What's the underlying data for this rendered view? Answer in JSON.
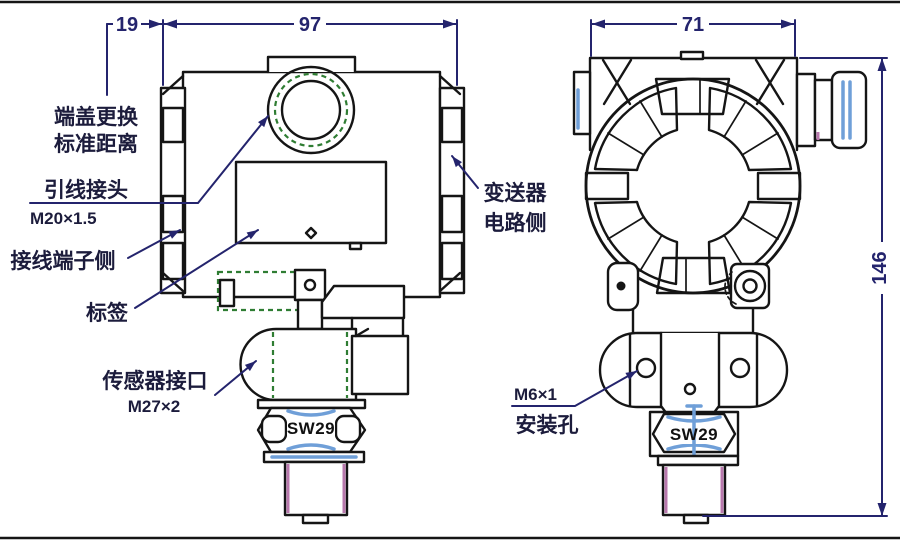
{
  "dimensions": {
    "cap_clearance": "19",
    "housing_length": "97",
    "housing_width": "71",
    "overall_height": "146"
  },
  "annotations": {
    "cap_note_line1": "端盖更换",
    "cap_note_line2": "标准距离",
    "cable_entry": "引线接头",
    "cable_entry_thread": "M20×1.5",
    "terminal_side": "接线端子侧",
    "tag": "标签",
    "sensor_port": "传感器接口",
    "sensor_port_thread": "M27×2",
    "circuit_side_line1": "变送器",
    "circuit_side_line2": "电路侧",
    "mounting_hole_thread": "M6×1",
    "mounting_hole": "安装孔",
    "wrench_size_side_view": "SW29",
    "wrench_size_front_view": "SW29"
  },
  "colors": {
    "outline": "#151515",
    "dimension_lines": "#24246d",
    "hidden_detail_green": "#2f7d33",
    "seal_pink": "#b878ad",
    "thread_blue": "#6f9fd8",
    "background": "#ffffff"
  }
}
